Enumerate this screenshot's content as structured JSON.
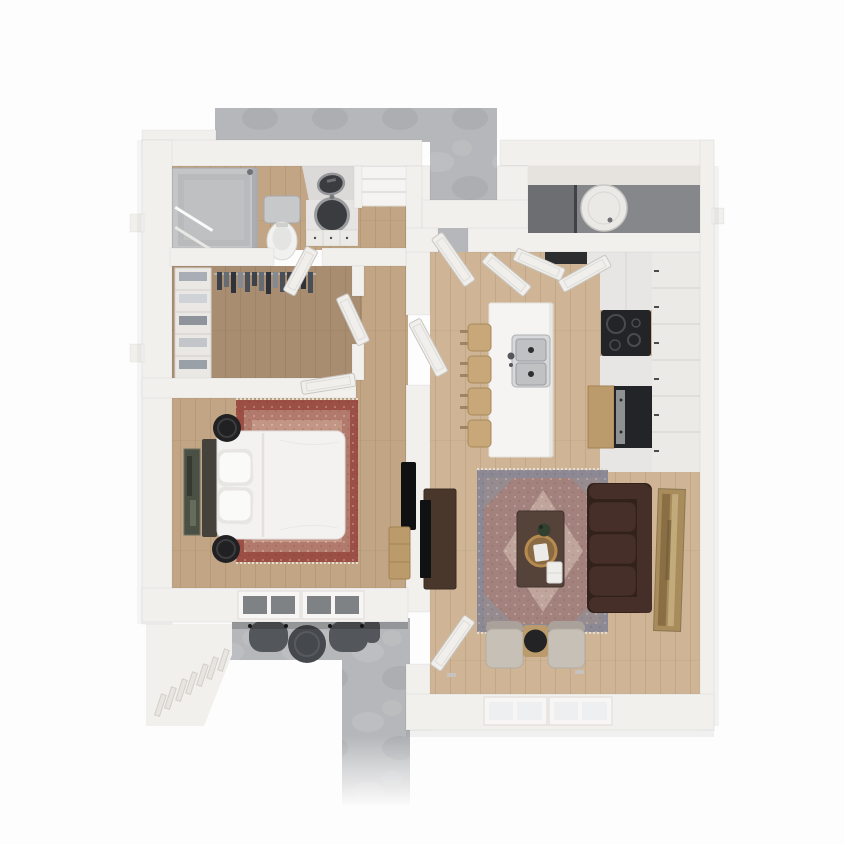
{
  "scene": {
    "description": "3D top-down architectural render of a one-bedroom apartment floor plan, no text labels",
    "rooms": [
      "entry-walkway",
      "bathroom",
      "linen-closet",
      "hallway",
      "walk-in-closet",
      "bedroom",
      "kitchen",
      "utility-closet",
      "living-room",
      "balcony-patio"
    ],
    "furniture": {
      "bathroom": [
        "walk-in-shower",
        "towel-bars",
        "toilet",
        "vanity-cabinet",
        "round-vanity-sink",
        "washer"
      ],
      "walk_in_closet": [
        "shelving-unit",
        "folded-clothes",
        "hanging-clothes-rail"
      ],
      "hallway": [
        "linen-shelves"
      ],
      "bedroom": [
        "double-bed-white-duvet",
        "headboard",
        "pillow-stacks",
        "round-nightstand-top",
        "round-nightstand-bottom",
        "red-persian-rug",
        "wall-art",
        "wall-tv",
        "dresser",
        "window-left",
        "window-right"
      ],
      "kitchen": [
        "island",
        "double-basin-sink",
        "faucet",
        "bar-stools-4",
        "upper-cabinets",
        "base-cabinets",
        "black-cooktop",
        "refrigerator",
        "tall-wood-cabinet",
        "open-cabinet-interior"
      ],
      "utility_closet": [
        "water-heater"
      ],
      "living_room": [
        "leather-sofa-3-seat",
        "blue-rust-persian-rug",
        "coffee-table",
        "gold-round-tray",
        "potted-plant",
        "white-tray",
        "accent-chair-left",
        "accent-chair-right",
        "side-table-round-top",
        "media-console",
        "tv",
        "wall-art",
        "window-left",
        "window-right"
      ],
      "balcony_patio": [
        "patio-chair-left",
        "patio-chair-right",
        "round-patio-table",
        "railing-wall"
      ]
    },
    "doors": [
      "entry-door",
      "utility-closet-doors",
      "bathroom-door",
      "closet-door",
      "bedroom-door",
      "hallway-door",
      "patio-door"
    ]
  },
  "colors": {
    "background": "#fdfdfd",
    "concrete": "#b5b7ba",
    "wall": "#f2f0ed",
    "wall_bright": "#fafaf8",
    "wall_shade": "#e6e3df",
    "wood_light": "#cfb596",
    "wood_mid": "#c1a584",
    "wood_dark": "#a88d70",
    "closet_interior": "#85878b",
    "water_heater": "#ebe9e6",
    "shower_pan": "#c4c5c7",
    "shower_glass": "#a9abae",
    "porcelain": "#f1f1f0",
    "fixture_gray": "#c7c8ca",
    "basin_dark": "#3a3c3f",
    "cabinet": "#eceae7",
    "counter": "#e7e6e4",
    "steel": "#c0c2c4",
    "appliance_black": "#232427",
    "fridge_steel": "#8f9193",
    "wood_tan": "#bb9b6c",
    "stool_wood": "#c8a878",
    "island_white": "#f5f4f2",
    "sofa_brown": "#452f28",
    "sofa_brown_dark": "#33211c",
    "chair_beige": "#c7c0b7",
    "chair_beige_dark": "#aaa29a",
    "coffee_table": "#55433a",
    "media_console": "#4a372c",
    "tray_gold": "#b78a4e",
    "plant_green": "#31402f",
    "black": "#1c1c1e",
    "rug_bed_border": "#9c4f44",
    "rug_bed_field": "#b27a6d",
    "rug_bed_inner": "#c69a8a",
    "rug_liv_border": "#8c8894",
    "rug_liv_field": "#a3827d",
    "rug_liv_center": "#c3a8a1",
    "art_bed": "#4b5044",
    "art_liv": "#a98c5c",
    "glass_dark": "#7e8284",
    "glass_light": "#edeff0",
    "door_white": "#f1efec",
    "patio_chair": "#53565b",
    "patio_table": "#45484c"
  }
}
